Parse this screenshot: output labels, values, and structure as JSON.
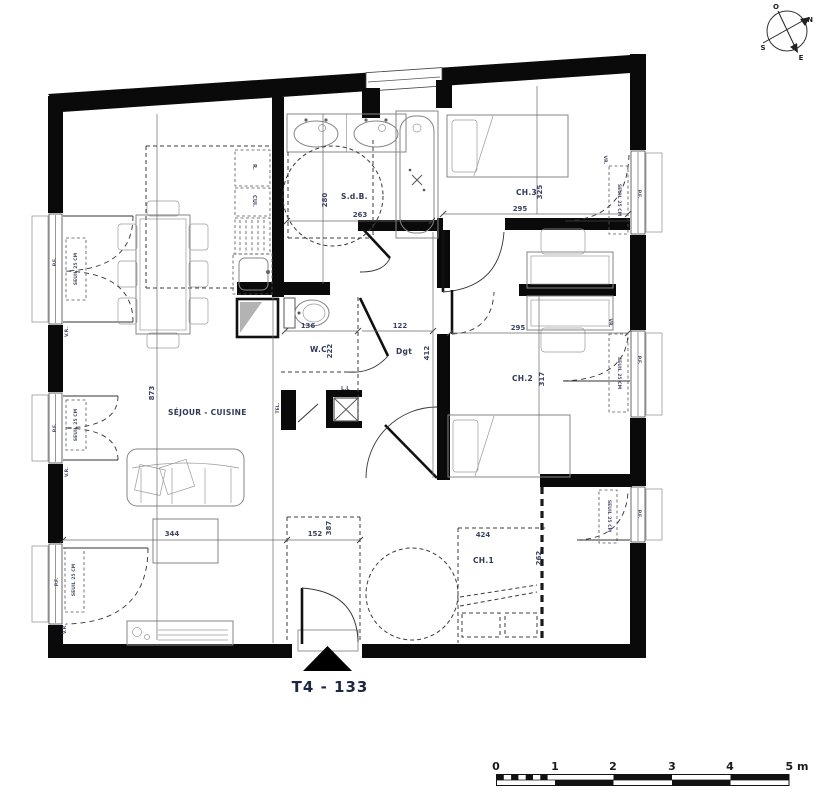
{
  "title": "T4 - 133",
  "compass": {
    "n": "N",
    "s": "S",
    "e": "E",
    "o": "O"
  },
  "rooms": {
    "sejour": {
      "name": "SÉJOUR - CUISINE",
      "dim_w": "344",
      "dim_h": "873"
    },
    "sdb": {
      "name": "S.d.B.",
      "dim_w": "263",
      "dim_h": "280"
    },
    "wc": {
      "name": "W.C",
      "dim_w": "136",
      "dim_h": "222"
    },
    "dgt": {
      "name": "Dgt",
      "dim_w": "122",
      "dim_h": "412"
    },
    "ch1": {
      "name": "CH.1",
      "dim_w": "424",
      "dim_h": "262"
    },
    "ch2": {
      "name": "CH.2",
      "dim_w": "295",
      "dim_h": "317"
    },
    "ch3": {
      "name": "CH.3",
      "dim_w": "295",
      "dim_h": "325"
    },
    "entry": {
      "dim_w": "152",
      "dim_h": "387"
    }
  },
  "fixtures": {
    "fridge": "R.",
    "stove": "CUI.",
    "washer": "L.L",
    "tel": "TEL."
  },
  "window_labels": {
    "threshold": "SEUIL 25 CM",
    "pf": "P.F.",
    "vr": "V.R.",
    "vr_right": "VR."
  },
  "scalebar": {
    "t0": "0",
    "t1": "1",
    "t2": "2",
    "t3": "3",
    "t4": "4",
    "t5": "5 m"
  },
  "colors": {
    "wall": "#0a0a0a",
    "dim_text": "#3a4462",
    "room_text": "#2f3a55",
    "title_text": "#1c2742"
  }
}
